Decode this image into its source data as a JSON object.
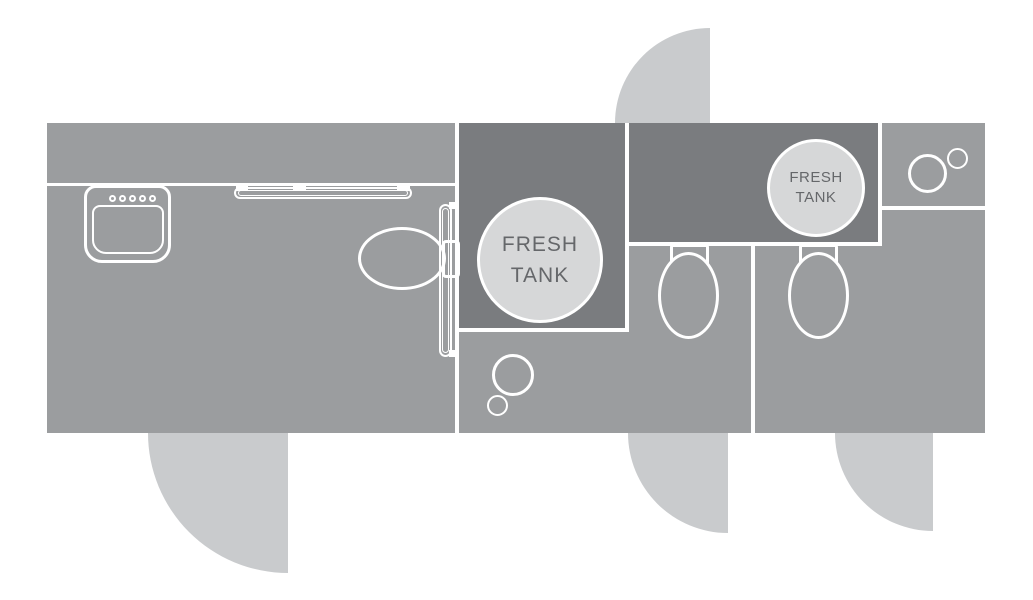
{
  "tanks": {
    "main": {
      "line1": "FRESH",
      "line2": "TANK"
    },
    "small": {
      "line1": "FRESH",
      "line2": "TANK"
    }
  },
  "colors": {
    "floor": "#9b9d9f",
    "tank_area": "#7a7c7f",
    "door_swing": "#c9cbcd",
    "tank_fill": "#d6d7d8",
    "tank_text": "#65676a",
    "wall": "#ffffff"
  }
}
